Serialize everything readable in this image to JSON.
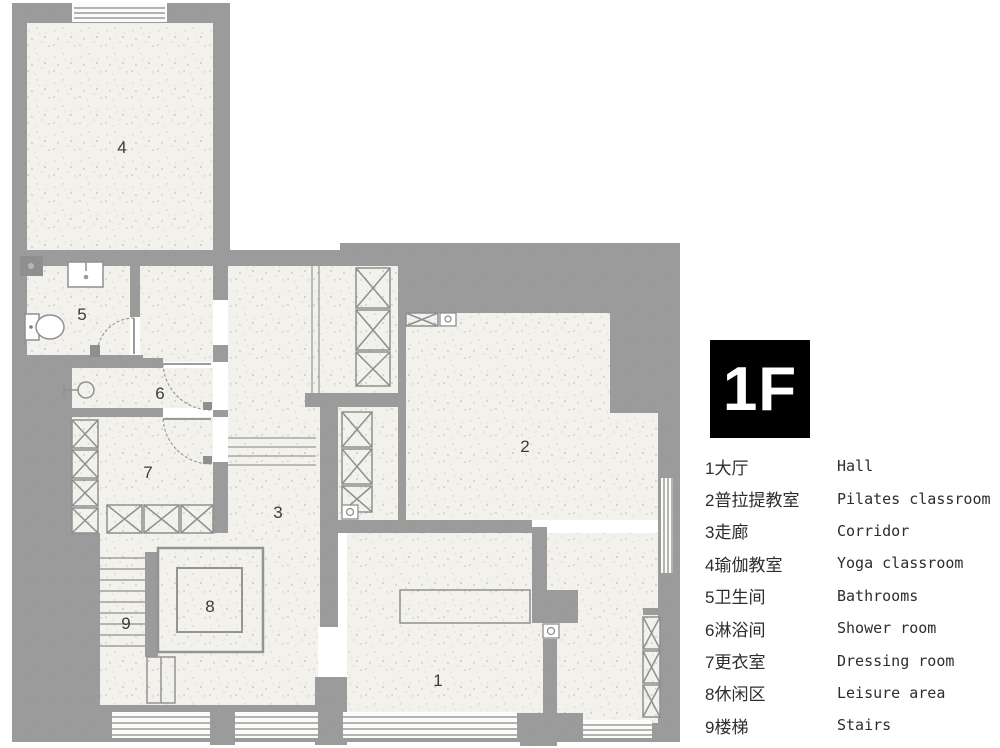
{
  "floor_badge": {
    "label": "1F"
  },
  "legend": {
    "items": [
      {
        "num": "1",
        "zh": "大厅",
        "en": "Hall"
      },
      {
        "num": "2",
        "zh": "普拉提教室",
        "en": "Pilates classroom"
      },
      {
        "num": "3",
        "zh": "走廊",
        "en": "Corridor"
      },
      {
        "num": "4",
        "zh": "瑜伽教室",
        "en": "Yoga classroom"
      },
      {
        "num": "5",
        "zh": "卫生间",
        "en": "Bathrooms"
      },
      {
        "num": "6",
        "zh": "淋浴间",
        "en": "Shower room"
      },
      {
        "num": "7",
        "zh": "更衣室",
        "en": "Dressing room"
      },
      {
        "num": "8",
        "zh": "休闲区",
        "en": "Leisure area"
      },
      {
        "num": "9",
        "zh": "楼梯",
        "en": "Stairs"
      }
    ]
  },
  "plan": {
    "labels": [
      {
        "text": "1",
        "room": "hall"
      },
      {
        "text": "2",
        "room": "pilates-classroom"
      },
      {
        "text": "3",
        "room": "corridor"
      },
      {
        "text": "4",
        "room": "yoga-classroom"
      },
      {
        "text": "5",
        "room": "bathroom"
      },
      {
        "text": "6",
        "room": "shower-room"
      },
      {
        "text": "7",
        "room": "dressing-room"
      },
      {
        "text": "8",
        "room": "leisure-area"
      },
      {
        "text": "9",
        "room": "stairs"
      }
    ]
  },
  "colors": {
    "wall": "#9b9b9b",
    "floor": "#f2f1ec",
    "ink": "#2d2d2d",
    "badge_bg": "#000000",
    "badge_fg": "#ffffff"
  }
}
